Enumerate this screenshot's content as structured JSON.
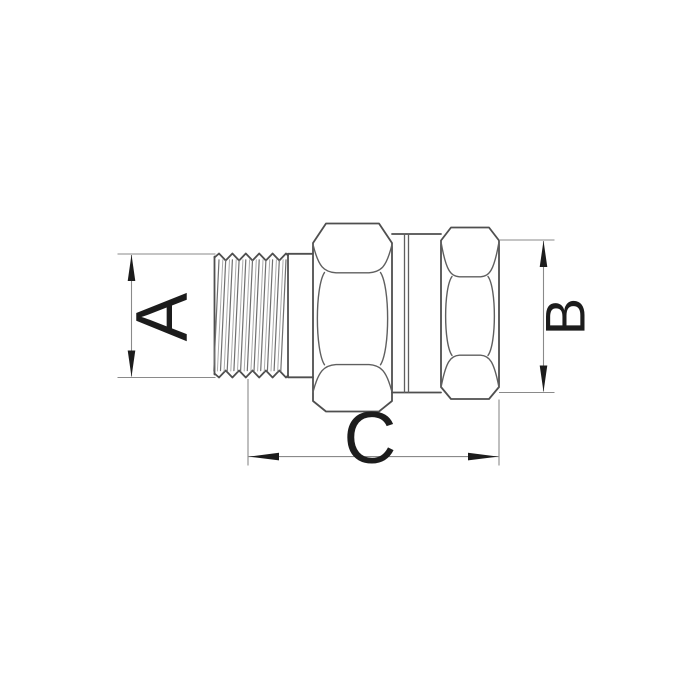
{
  "drawing": {
    "colors": {
      "background": "#ffffff",
      "outline": "#4f4f4f",
      "inner_line": "#5f5f5f",
      "hatch_dark": "#6f6f6f",
      "hatch_light": "#ababab",
      "dimension_line": "#8a8a8a",
      "arrow": "#1c1c1c",
      "label": "#1c1c1c"
    }
  },
  "dimensions": {
    "a": {
      "label": "A"
    },
    "b": {
      "label": "B"
    },
    "c": {
      "label": "C"
    }
  }
}
